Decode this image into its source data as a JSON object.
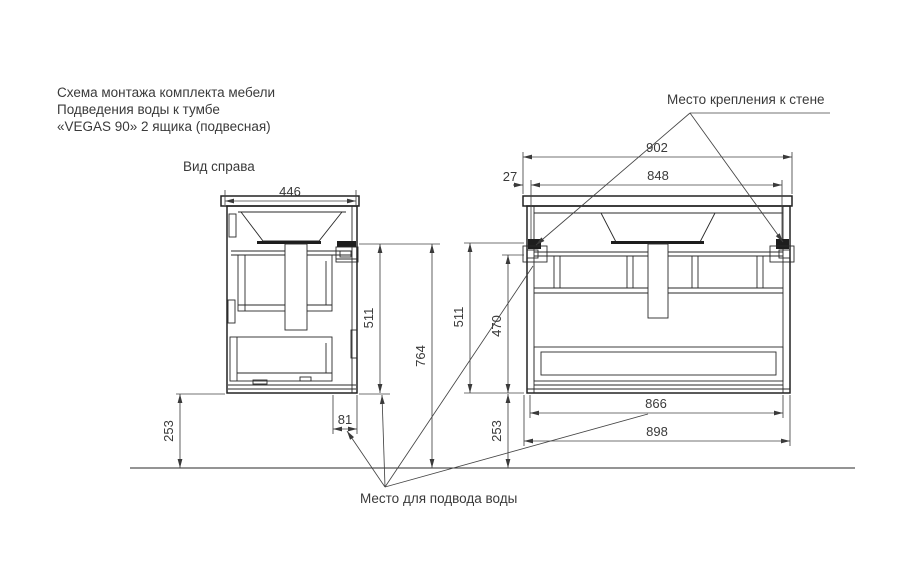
{
  "page": {
    "background": "#ffffff",
    "line_color": "#222222",
    "dim_line_color": "#444444",
    "text_color": "#3a3a3a"
  },
  "title": {
    "line1": "Схема монтажа комплекта мебели",
    "line2": "Подведения воды к тумбе",
    "line3": "«VEGAS 90» 2 ящика (подвесная)"
  },
  "side_view": {
    "label": "Вид справа",
    "dims": {
      "top_width": "446",
      "cabinet_height": "511",
      "mount_height": "764",
      "floor_gap": "253",
      "water_offset": "81"
    }
  },
  "front_view": {
    "dims": {
      "top_width": "902",
      "bracket_inset": "27",
      "bracket_span": "848",
      "cabinet_height": "511",
      "inner_height": "470",
      "floor_gap": "253",
      "bottom_inner_width": "866",
      "bottom_outer_width": "898"
    }
  },
  "annotations": {
    "wall_mount_label": "Место крепления к стене",
    "water_supply_label": "Место для подвода воды"
  }
}
